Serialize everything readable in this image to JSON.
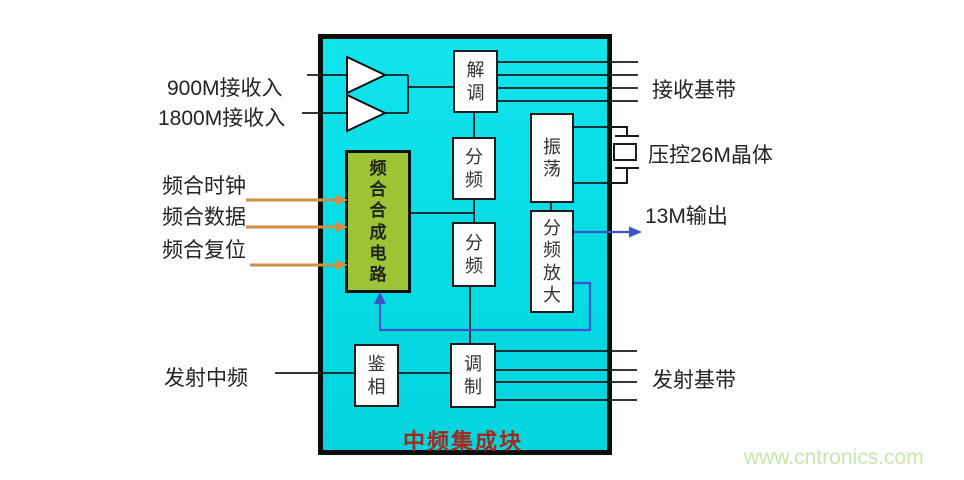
{
  "diagram": {
    "title": "中频集成块",
    "watermark": "www.cntronics.com",
    "inputs": {
      "rx900": "900M接收入",
      "rx1800": "1800M接收入",
      "synth_clock": "频合时钟",
      "synth_data": "频合数据",
      "synth_reset": "频合复位",
      "tx_if": "发射中频"
    },
    "outputs": {
      "rx_baseband": "接收基带",
      "vcxo": "压控26M晶体",
      "out_13m": "13M输出",
      "tx_baseband": "发射基带"
    },
    "blocks": {
      "demod": "解调",
      "divider1": "分频",
      "divider2": "分频",
      "oscillator": "振荡",
      "divider_amp": "分频放大",
      "synthesizer": "频合合成电路",
      "phase_detector": "鉴相",
      "modulator": "调制"
    },
    "colors": {
      "module_fill": "#06dbe3",
      "synth_fill": "#9cc434",
      "title_color": "#a6281c",
      "signal_blue": "#3d53c9",
      "signal_orange": "#cf9045",
      "watermark_color": "#c8e7ad"
    }
  }
}
